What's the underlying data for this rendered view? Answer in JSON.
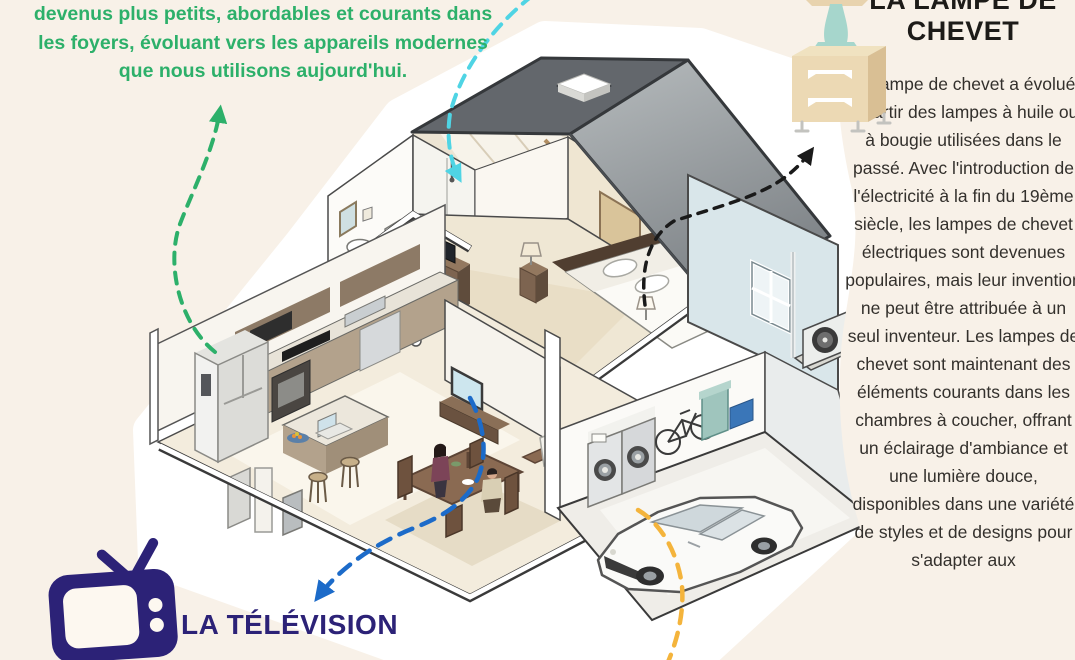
{
  "page": {
    "background_color": "#f8f1e8",
    "type": "infographic",
    "language": "fr"
  },
  "intro": {
    "lines": [
      "devenus plus petits, abordables et courants dans",
      "les foyers, évoluant vers les appareils modernes",
      "que nous utilisons aujourd'hui."
    ],
    "color": "#2db06a"
  },
  "lamp_section": {
    "title_lines": [
      "LA LAMPE DE",
      "CHEVET"
    ],
    "body": "La lampe de chevet a évolué à partir des lampes à huile ou à bougie utilisées dans le passé. Avec l'introduction de l'électricité à la fin du 19ème siècle, les lampes de chevet électriques sont devenues populaires, mais leur invention ne peut être attribuée à un seul inventeur. Les lampes de chevet sont maintenant des éléments courants dans les chambres à coucher, offrant un éclairage d'ambiance et une lumière douce, disponibles dans une variété de styles et de designs pour s'adapter aux",
    "icon": "nightstand-lamp-icon",
    "title_color": "#1d1b18",
    "body_color": "#33302c"
  },
  "tv_section": {
    "label": "LA TÉLÉVISION",
    "icon": "television-icon",
    "color": "#2c2277"
  },
  "illustration": {
    "description": "isometric cutaway house with bathroom, bedroom, kitchen, dining room and garage",
    "arrows": [
      {
        "name": "green-dashed-arrow",
        "color": "#2db06a",
        "from": "refrigerator",
        "to": "intro-text"
      },
      {
        "name": "cyan-dashed-arrow",
        "color": "#4fd4e4",
        "from": "top-edge",
        "to": "shower"
      },
      {
        "name": "black-dashed-arrow",
        "color": "#1a1a1a",
        "from": "bedside-lamp",
        "to": "lamp-section"
      },
      {
        "name": "blue-dashed-arrow",
        "color": "#1c6bc9",
        "from": "living-room-tv",
        "to": "tv-label"
      },
      {
        "name": "yellow-dashed-line",
        "color": "#f4b43c",
        "from": "garage",
        "to": "bottom-edge"
      }
    ]
  }
}
